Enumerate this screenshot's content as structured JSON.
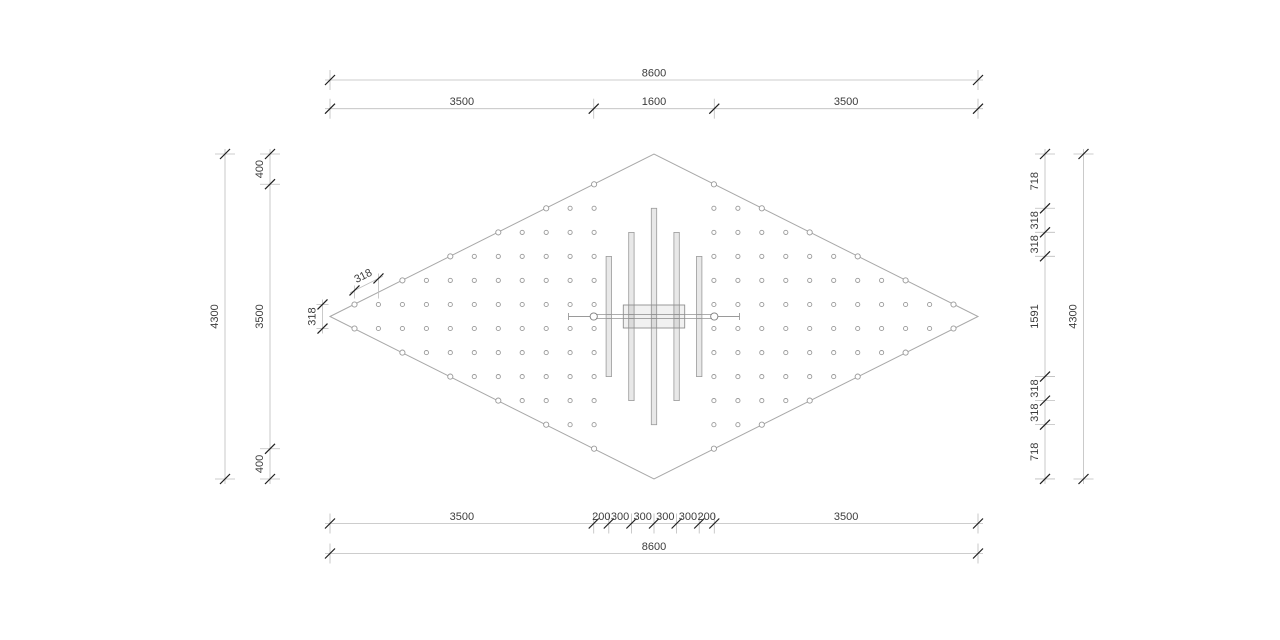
{
  "drawing": {
    "type": "pile-foundation-layout-plan",
    "grid": {
      "spacing": 318,
      "first_row_offset": 159,
      "first_col_offset": 795,
      "half_rows": 6,
      "max_col_index": 10
    },
    "structure": {
      "bar_count": 5,
      "bar_spacing": 300,
      "strip_width": 1600
    },
    "dimensions": {
      "top": [
        {
          "name": "dim-top-overall",
          "segments": [
            8600
          ]
        },
        {
          "name": "dim-top-spans",
          "segments": [
            3500,
            1600,
            3500
          ]
        }
      ],
      "bottom": [
        {
          "name": "dim-bottom-spans",
          "segments": [
            3500,
            200,
            300,
            300,
            300,
            300,
            200,
            3500
          ]
        },
        {
          "name": "dim-bottom-overall",
          "segments": [
            8600
          ]
        }
      ],
      "left": [
        {
          "name": "dim-left-overall",
          "segments": [
            4300
          ]
        },
        {
          "name": "dim-left-spans",
          "segments": [
            400,
            3500,
            400
          ]
        }
      ],
      "right": [
        {
          "name": "dim-right-spans",
          "segments": [
            718,
            318,
            318,
            1591,
            318,
            318,
            718
          ]
        },
        {
          "name": "dim-right-overall",
          "segments": [
            4300
          ]
        }
      ],
      "vertex_edge_dim": {
        "label": "318"
      },
      "vertex_vertical_dim": {
        "label": "318"
      }
    },
    "colors": {
      "outline": "#a8a8a8",
      "dim_line": "#bdbdbd",
      "tick": "#1f1f1f",
      "text": "#3c3c3c",
      "dot_stroke": "#9a9a9a",
      "structure_stroke": "#9a9a9a",
      "bar_fill": "rgba(0,0,0,0.09)",
      "panel_fill": "rgba(0,0,0,0.055)",
      "white": "#ffffff"
    }
  }
}
